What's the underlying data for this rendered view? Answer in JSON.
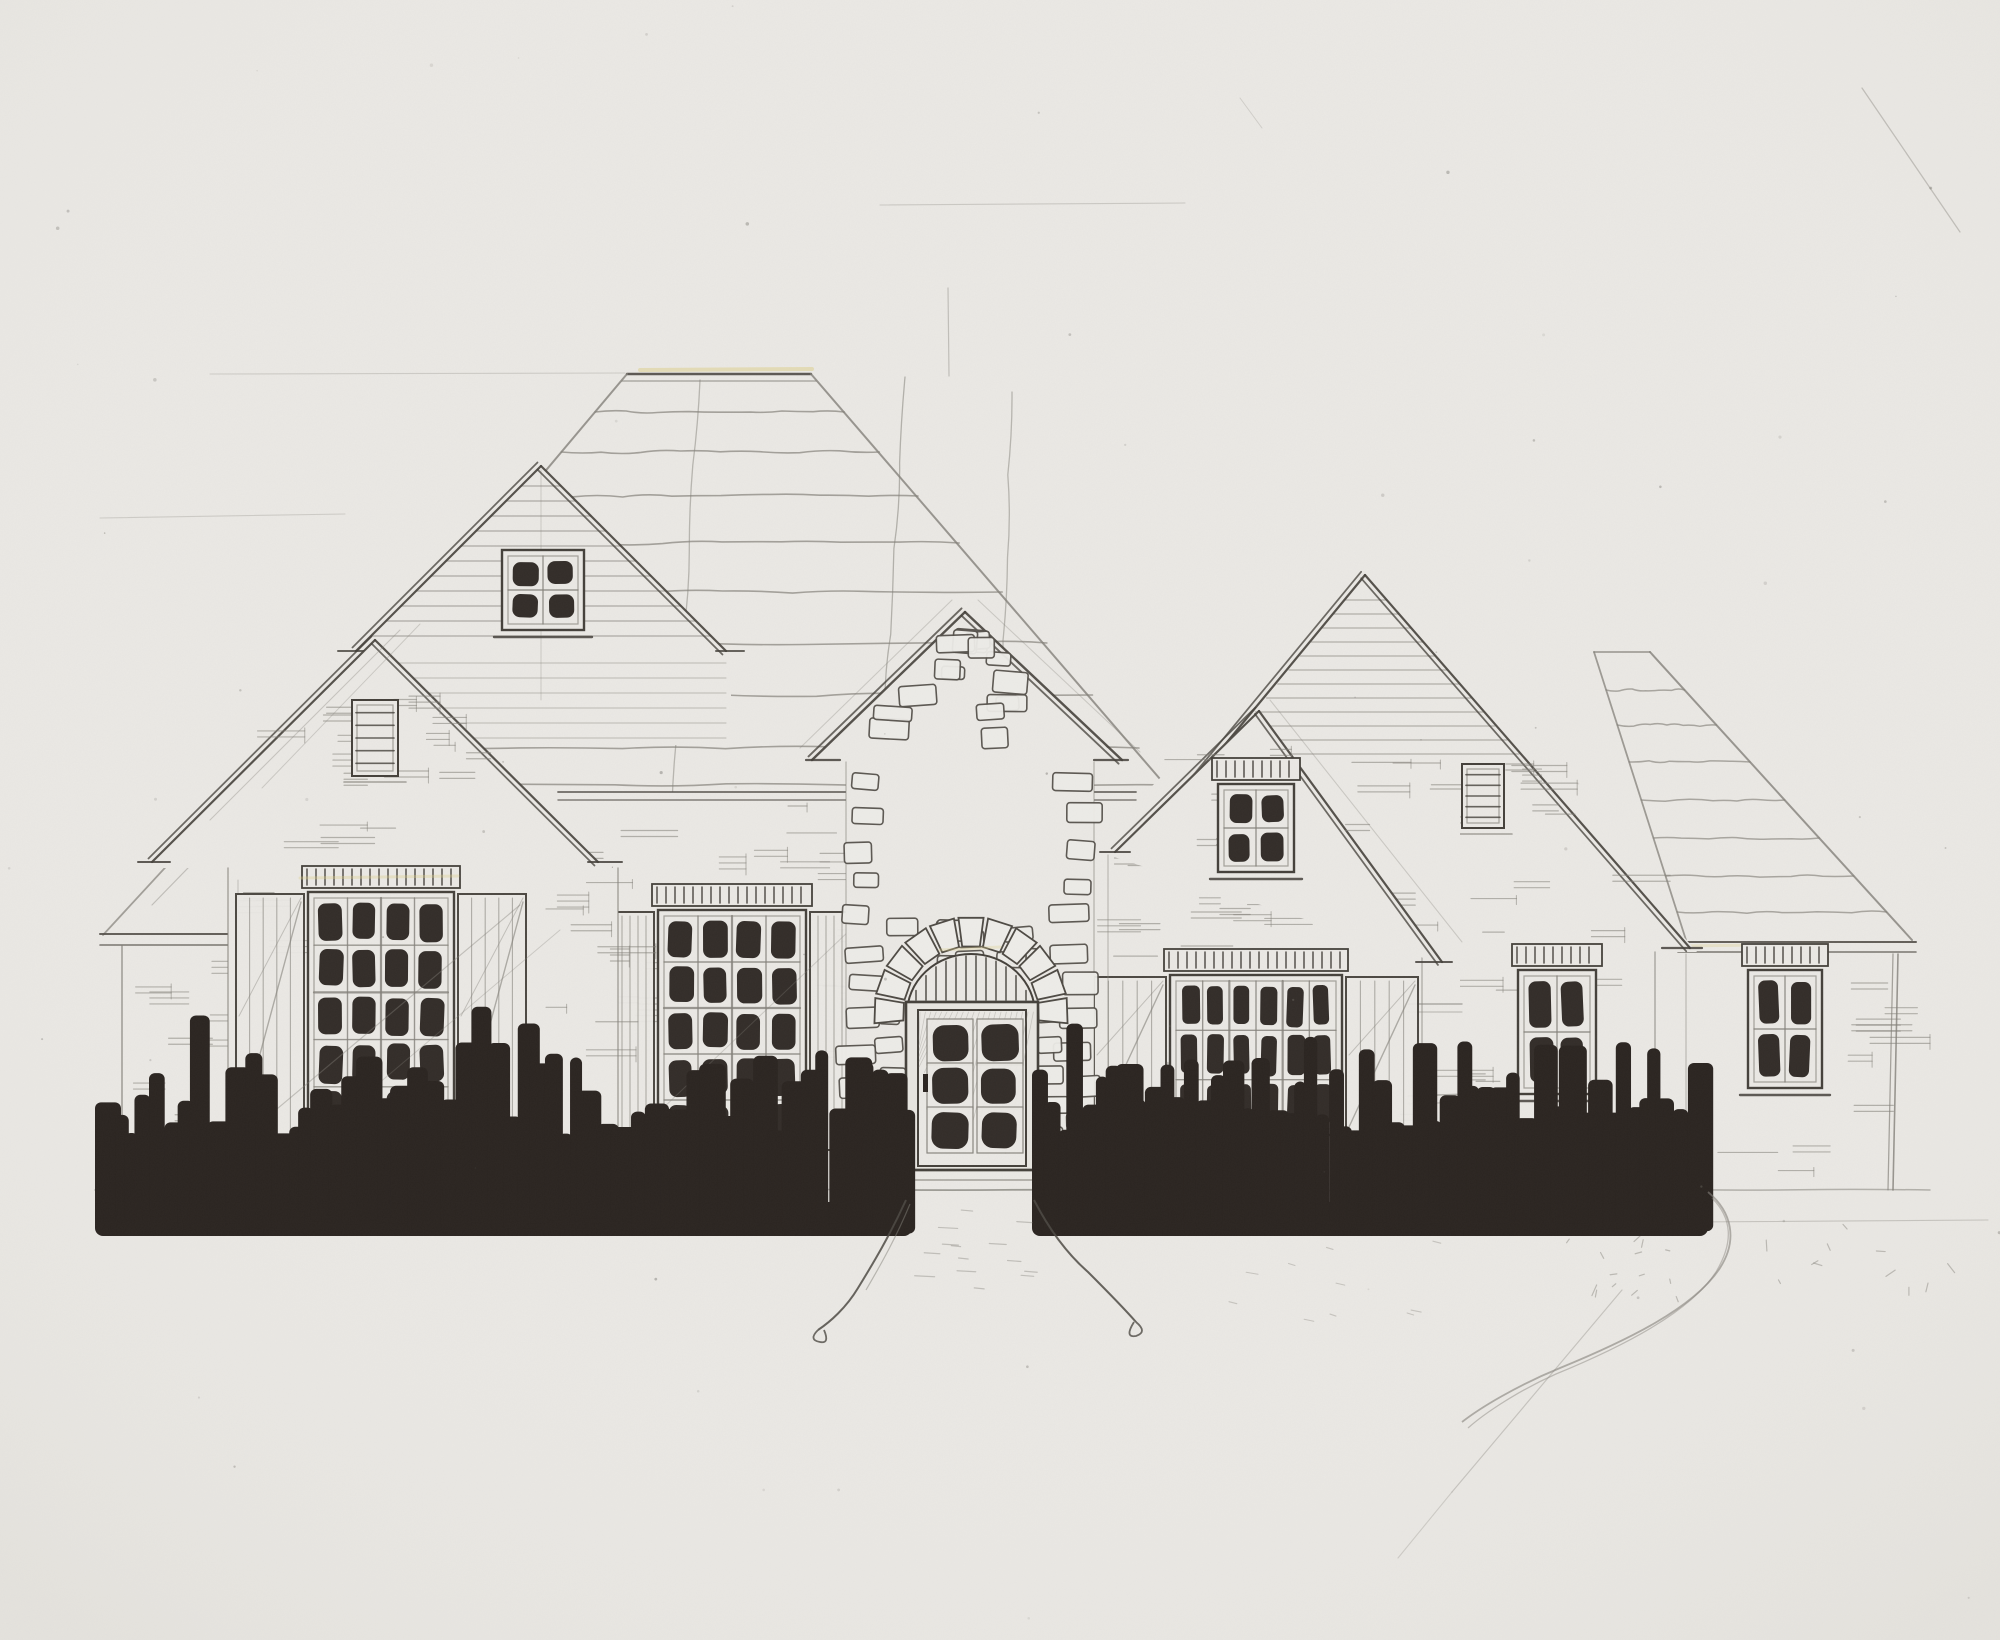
{
  "artwork": {
    "title": "Hand-drawn front elevation sketch of a single-story French-country style house",
    "medium": "pencil and ink on scanned paper",
    "visible_text": "none"
  },
  "palette": {
    "paper": "#eae8e4",
    "pencil": "#84817a",
    "pencil_faint": "#9b988f",
    "ink": "#45413b",
    "dark_fill": "#2b2521",
    "stone_fill": "#edece8",
    "highlight_yellow": "#ddd08a"
  },
  "scene": {
    "ground_y": 1190,
    "roof": {
      "flat_top_x1": 627,
      "flat_top_x2": 811,
      "flat_top_y": 374
    },
    "gable_peaks": {
      "left_tall": [
        541,
        466
      ],
      "left_front": [
        375,
        640
      ],
      "entry": [
        965,
        612
      ],
      "middle": [
        1259,
        711
      ],
      "right_large": [
        1365,
        575
      ],
      "right_wing_hip": [
        1620,
        652
      ]
    },
    "windows": [
      {
        "id": "left-tall-gable-window",
        "group": "g-lgable",
        "x": 512,
        "y": 560,
        "w": 62,
        "h": 60,
        "cols": 2,
        "rows": 2,
        "crown": false,
        "shutters": 0,
        "sill": true
      },
      {
        "id": "great-room-window",
        "group": "g-sgable",
        "x": 318,
        "y": 902,
        "w": 126,
        "h": 228,
        "cols": 4,
        "rows": 5,
        "crown": true,
        "shutters": 68,
        "sill": false,
        "braces": true
      },
      {
        "id": "dining-window",
        "group": "g-wall",
        "x": 668,
        "y": 920,
        "w": 128,
        "h": 222,
        "cols": 4,
        "rows": 5,
        "crown": true,
        "shutters": 40,
        "sill": false,
        "braces": false
      },
      {
        "id": "entry-gable-window",
        "group": "g-entry",
        "x": 946,
        "y": 780,
        "w": 56,
        "h": 78,
        "cols": 2,
        "rows": 2,
        "crown": false,
        "shutters": 0,
        "sill": true,
        "stone": true
      },
      {
        "id": "middle-gable-window",
        "group": "g-mgable",
        "x": 1228,
        "y": 794,
        "w": 56,
        "h": 68,
        "cols": 2,
        "rows": 2,
        "crown": true,
        "shutters": 0,
        "sill": true
      },
      {
        "id": "family-room-window",
        "group": "g-wall",
        "x": 1180,
        "y": 985,
        "w": 152,
        "h": 140,
        "cols": 6,
        "rows": 3,
        "crown": true,
        "shutters": 72,
        "sill": false,
        "braces": true
      },
      {
        "id": "right-gable-window",
        "group": "g-rgable",
        "x": 1528,
        "y": 980,
        "w": 58,
        "h": 104,
        "cols": 2,
        "rows": 2,
        "crown": true,
        "shutters": 0,
        "sill": true
      },
      {
        "id": "right-wing-window",
        "group": "g-rwing",
        "x": 1758,
        "y": 980,
        "w": 54,
        "h": 98,
        "cols": 2,
        "rows": 2,
        "crown": true,
        "shutters": 0,
        "sill": true
      }
    ],
    "vents": [
      {
        "id": "left-front-gable-vent",
        "group": "g-sgable",
        "x": 352,
        "y": 700,
        "w": 46,
        "h": 76
      },
      {
        "id": "right-gable-vent",
        "group": "g-rgable",
        "x": 1462,
        "y": 764,
        "w": 42,
        "h": 64
      }
    ],
    "door": {
      "id": "entry-door",
      "x": 906,
      "y": 1002,
      "w": 132,
      "h": 168,
      "pane_cols": 2,
      "pane_rows": 3,
      "arch_cx": 971,
      "arch_cy": 1014,
      "arch_r_inner": 64,
      "arch_r_outer": 97,
      "transom": "vertical bars under stone arch",
      "steps": 3
    },
    "shrubs": {
      "left_band": [
        95,
        912
      ],
      "right_band": [
        1032,
        1708
      ],
      "top_min": 1055,
      "bottom": 1238,
      "style": "solid dark ink hedge"
    },
    "walkway": {
      "top_x1": 906,
      "top_x2": 1034,
      "flare_to_y": 1330,
      "detail": "sketched flagstone dashes, looped line ends"
    }
  }
}
